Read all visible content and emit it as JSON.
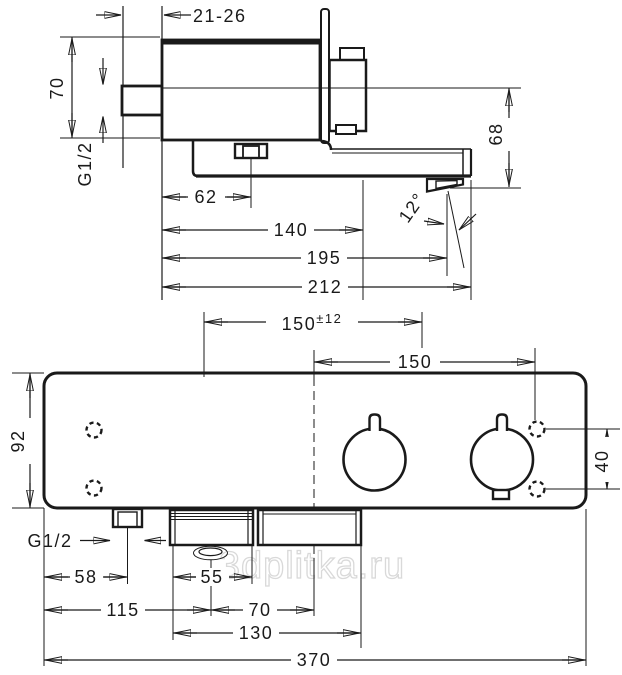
{
  "watermark": "3dplitka.ru",
  "colors": {
    "line": "#1a1a1a",
    "watermark_outline": "#d9d9d9"
  },
  "side_view": {
    "dims": {
      "wall_depth": "21-26",
      "body_height": "70",
      "inlet_thread": "G1/2",
      "nut_offset": "62",
      "hose_outlet_offset": "140",
      "spout_outlet_offset": "195",
      "spout_length": "212",
      "outlet_drop": "68",
      "spout_angle": "12°"
    }
  },
  "front_view": {
    "dims": {
      "connection_spacing": "150",
      "connection_tolerance": "±12",
      "handle_to_center": "150",
      "body_height": "92",
      "hole_spacing": "40",
      "inlet_thread": "G1/2",
      "inlet_offset": "58",
      "hose_block_width": "55",
      "hose_center_offset": "115",
      "hose_to_center": "70",
      "bottom_block_width": "130",
      "total_width": "370"
    }
  }
}
